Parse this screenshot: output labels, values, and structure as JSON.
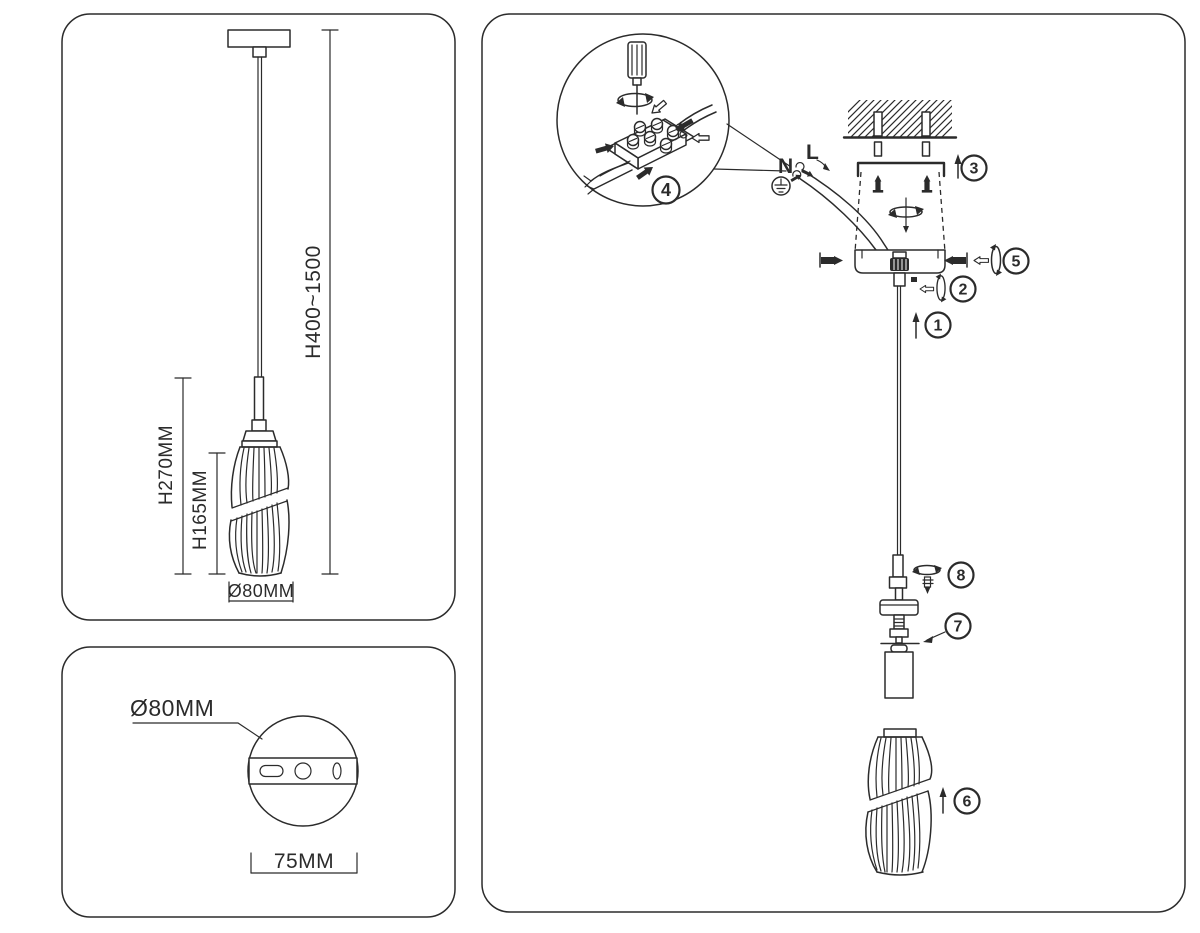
{
  "colors": {
    "ink": "#2b2b2b",
    "paper": "#ffffff"
  },
  "dimension_panel": {
    "height_range": "H400~1500",
    "shade_total_height": "H270MM",
    "shade_glass_height": "H165MM",
    "shade_diameter": "Ø80MM"
  },
  "canopy_panel": {
    "canopy_diameter": "Ø80MM",
    "canopy_width": "75MM"
  },
  "assembly_panel": {
    "wire_neutral": "N",
    "wire_live": "L",
    "steps": [
      "1",
      "2",
      "3",
      "4",
      "5",
      "6",
      "7",
      "8"
    ]
  }
}
